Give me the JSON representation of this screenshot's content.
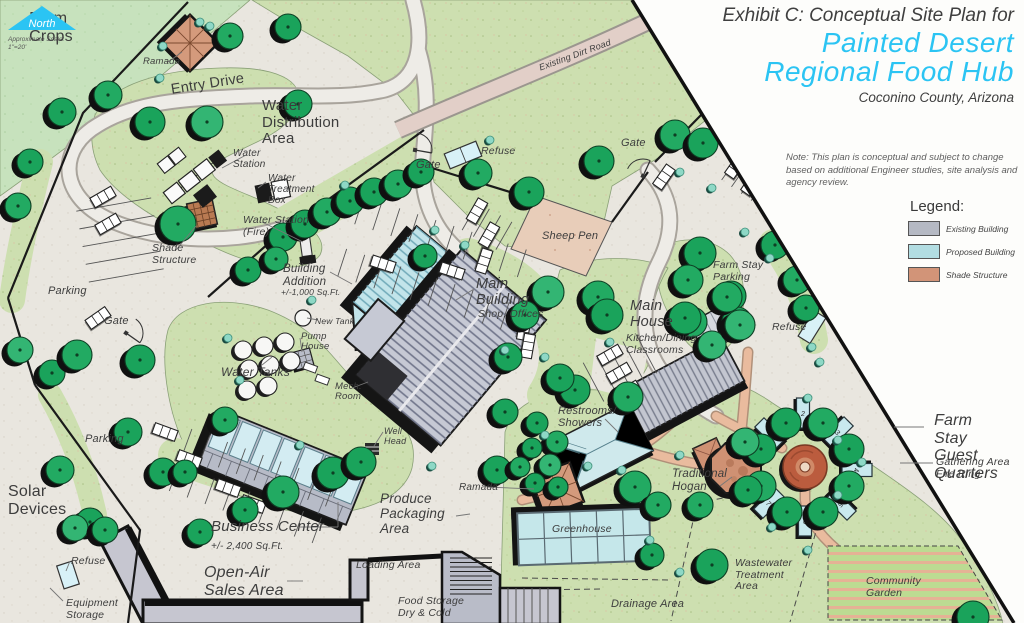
{
  "title_block": {
    "exhibit": "Exhibit C: Conceptual Site Plan for",
    "name_line1": "Painted Desert",
    "name_line2": "Regional Food Hub",
    "subtitle": "Coconino County, Arizona"
  },
  "note": "Note: This plan is conceptual and subject to change based on additional Engineer studies, site analysis and agency review.",
  "legend": {
    "heading": "Legend:",
    "items": [
      {
        "label": "Existing Building",
        "color": "#b5b9c3"
      },
      {
        "label": "Proposed Building",
        "color": "#b2dde2"
      },
      {
        "label": "Shade Structure",
        "color": "#d29478"
      }
    ]
  },
  "north_arrow": {
    "label": "North",
    "scale_label": "Approximate Scale:",
    "scale_value": "1\"=20'"
  },
  "farm_stay": {
    "cabin_numbers": [
      "1",
      "2",
      "3",
      "4",
      "5",
      "6",
      "7"
    ]
  },
  "colors": {
    "accent": "#2bc4f3",
    "text": "#3d3d3d",
    "existing_building": "#b5b9c3",
    "proposed_building": "#b2dde2",
    "shade_structure": "#d29478",
    "tree": "#1aa35b",
    "planting": "#cddfb0",
    "walkway": "#e9bb9e",
    "dirt_road": "#e2cfc8",
    "base": "#e9e6df"
  },
  "map_labels": [
    {
      "id": "farm-crops",
      "text": "Farm\nCrops",
      "x": 51,
      "y": 10,
      "size": 16,
      "align": "center",
      "italic": false
    },
    {
      "id": "ramada-top",
      "text": "Ramada",
      "x": 143,
      "y": 57,
      "size": 9.5
    },
    {
      "id": "entry-drive",
      "text": "Entry Drive",
      "x": 170,
      "y": 83,
      "size": 14.5,
      "rot": -9,
      "italic": false
    },
    {
      "id": "water-distribution-area",
      "text": "Water\nDistribution\nArea",
      "x": 262,
      "y": 98,
      "size": 15,
      "italic": false
    },
    {
      "id": "water-station",
      "text": "Water\nStation",
      "x": 233,
      "y": 148,
      "size": 10
    },
    {
      "id": "water-treatment-box",
      "text": "Water\nTreatment\nBox",
      "x": 268,
      "y": 173,
      "size": 10
    },
    {
      "id": "water-station-fire",
      "text": "Water Station\n(Fire)",
      "x": 243,
      "y": 215,
      "size": 10.5
    },
    {
      "id": "shade-structure",
      "text": "Shade\nStructure",
      "x": 152,
      "y": 243,
      "size": 10.5
    },
    {
      "id": "parking-upper",
      "text": "Parking",
      "x": 48,
      "y": 285,
      "size": 11
    },
    {
      "id": "gate-left",
      "text": "Gate",
      "x": 104,
      "y": 315,
      "size": 11
    },
    {
      "id": "gate-mid",
      "text": "Gate",
      "x": 416,
      "y": 159,
      "size": 11
    },
    {
      "id": "gate-right",
      "text": "Gate",
      "x": 621,
      "y": 137,
      "size": 11
    },
    {
      "id": "refuse-top",
      "text": "Refuse",
      "x": 481,
      "y": 146,
      "size": 10.5
    },
    {
      "id": "sheep-pen",
      "text": "Sheep Pen",
      "x": 542,
      "y": 230,
      "size": 11
    },
    {
      "id": "farm-stay-parking",
      "text": "Farm Stay\nParking",
      "x": 713,
      "y": 260,
      "size": 10.5
    },
    {
      "id": "refuse-right",
      "text": "Refuse",
      "x": 772,
      "y": 322,
      "size": 10.5
    },
    {
      "id": "building-addition",
      "text": "Building\nAddition",
      "x": 283,
      "y": 263,
      "size": 11.5
    },
    {
      "id": "building-addition-size",
      "text": "+/-1,000 Sq.Ft.",
      "x": 281,
      "y": 288,
      "size": 8.5
    },
    {
      "id": "main-building",
      "text": "Main\nBuilding",
      "x": 476,
      "y": 277,
      "size": 14.5
    },
    {
      "id": "main-building-sub",
      "text": "Shop, Offices",
      "x": 478,
      "y": 309,
      "size": 10.5
    },
    {
      "id": "main-house",
      "text": "Main\nHouse",
      "x": 630,
      "y": 299,
      "size": 14.5
    },
    {
      "id": "main-house-sub",
      "text": "Kitchen/Dining\nClassrooms",
      "x": 626,
      "y": 333,
      "size": 10.5
    },
    {
      "id": "new-tank",
      "text": "New Tank",
      "x": 315,
      "y": 317,
      "size": 8.5
    },
    {
      "id": "pump-house",
      "text": "Pump\nHouse",
      "x": 301,
      "y": 332,
      "size": 9.5
    },
    {
      "id": "water-tanks",
      "text": "Water Tanks",
      "x": 221,
      "y": 366,
      "size": 12
    },
    {
      "id": "mech-room",
      "text": "Mech.\nRoom",
      "x": 335,
      "y": 382,
      "size": 9.5
    },
    {
      "id": "well-head",
      "text": "Well\nHead",
      "x": 384,
      "y": 427,
      "size": 9
    },
    {
      "id": "restrooms-showers",
      "text": "Restrooms/\nShowers",
      "x": 558,
      "y": 405,
      "size": 11
    },
    {
      "id": "ramada-center",
      "text": "Ramada",
      "x": 459,
      "y": 482,
      "size": 10
    },
    {
      "id": "traditional-hogan",
      "text": "Traditional\nHogan",
      "x": 672,
      "y": 468,
      "size": 11.5
    },
    {
      "id": "business-center",
      "text": "Business Center",
      "x": 211,
      "y": 519,
      "size": 15
    },
    {
      "id": "business-center-size",
      "text": "+/- 2,400 Sq.Ft.",
      "x": 211,
      "y": 541,
      "size": 10
    },
    {
      "id": "produce-packaging",
      "text": "Produce\nPackaging\nArea",
      "x": 380,
      "y": 492,
      "size": 13.5
    },
    {
      "id": "loading-area",
      "text": "Loading Area",
      "x": 356,
      "y": 560,
      "size": 10.5
    },
    {
      "id": "open-air-sales",
      "text": "Open-Air\nSales Area",
      "x": 204,
      "y": 564,
      "size": 16
    },
    {
      "id": "food-storage",
      "text": "Food Storage\nDry & Cold",
      "x": 398,
      "y": 596,
      "size": 10.5
    },
    {
      "id": "greenhouse",
      "text": "Greenhouse",
      "x": 552,
      "y": 524,
      "size": 10.5
    },
    {
      "id": "drainage-area",
      "text": "Drainage Area",
      "x": 611,
      "y": 598,
      "size": 11
    },
    {
      "id": "wastewater-treatment",
      "text": "Wastewater\nTreatment\nArea",
      "x": 735,
      "y": 558,
      "size": 10.5
    },
    {
      "id": "community-garden",
      "text": "Community\nGarden",
      "x": 866,
      "y": 576,
      "size": 10.5
    },
    {
      "id": "solar-devices",
      "text": "Solar\nDevices",
      "x": 8,
      "y": 483,
      "size": 16,
      "italic": false
    },
    {
      "id": "equipment-storage",
      "text": "Equipment\nStorage",
      "x": 66,
      "y": 598,
      "size": 10.5
    },
    {
      "id": "refuse-bottom",
      "text": "Refuse",
      "x": 71,
      "y": 556,
      "size": 10.5
    },
    {
      "id": "parking-lower",
      "text": "Parking",
      "x": 85,
      "y": 433,
      "size": 11
    },
    {
      "id": "existing-dirt-road",
      "text": "Existing Dirt Road",
      "x": 538,
      "y": 64,
      "size": 9,
      "rot": -20
    },
    {
      "id": "farm-stay-guest-quarters",
      "text": "Farm Stay\nGuest Quarters",
      "x": 966,
      "y": 412,
      "size": 16,
      "align": "center"
    },
    {
      "id": "gathering-area",
      "text": "Gathering Area\nFire Ring",
      "x": 936,
      "y": 457,
      "size": 10.5
    }
  ]
}
